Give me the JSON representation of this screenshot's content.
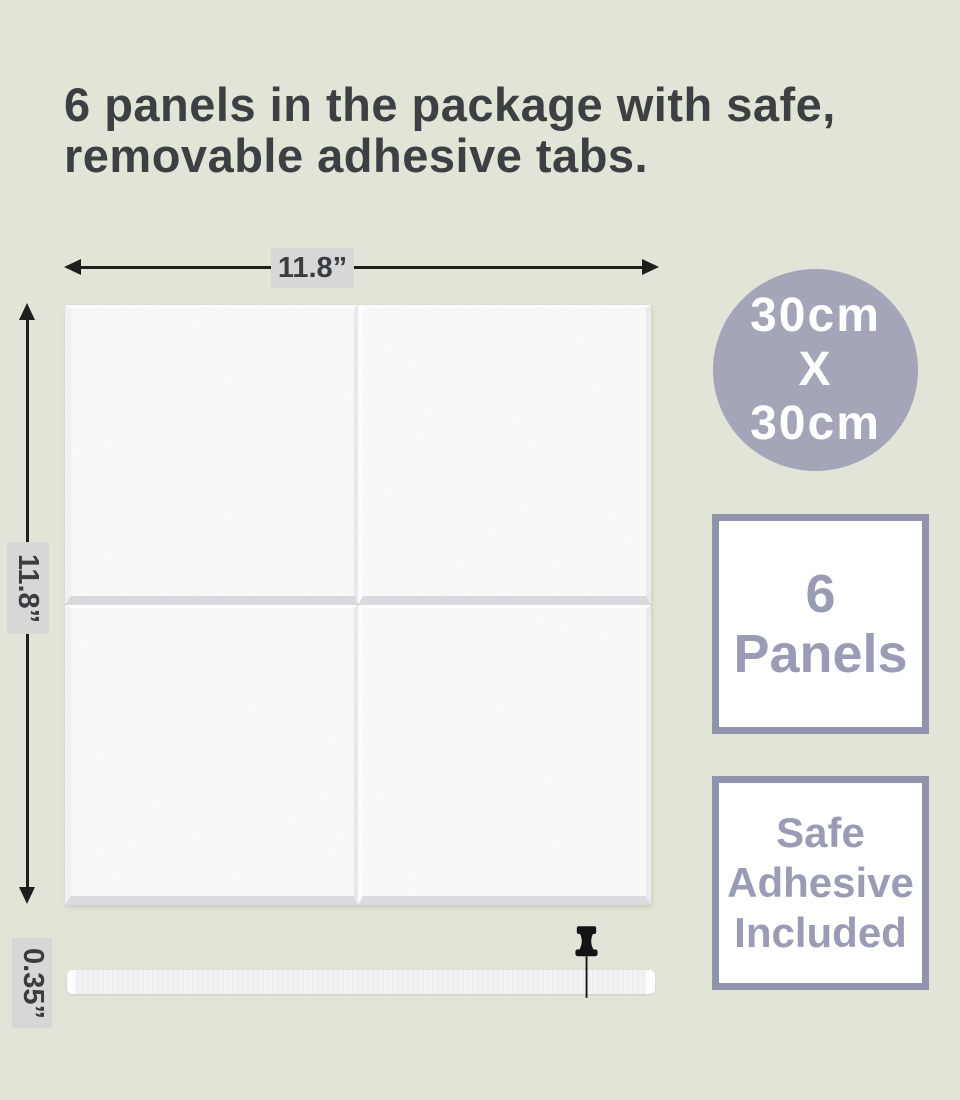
{
  "colors": {
    "page-bg": "#e1e4d6",
    "heading-text": "#3d4043",
    "arrow": "#1e1e1e",
    "dim-label-bg": "#d7d7d7",
    "dim-label-text": "#3a3d40",
    "panel-face": "#fafafb",
    "panel-bevel": "#d9d9dd",
    "circle-bg": "#a5a5ba",
    "circle-text": "#ffffff",
    "badge-border": "#9093ab",
    "badge-text": "#9a9bb4",
    "pin": "#131313",
    "strip-face": "#f3f3f5"
  },
  "heading": {
    "line1": "6 panels in the package with safe,",
    "line2": "removable adhesive tabs."
  },
  "dimensions": {
    "width": "11.8”",
    "height": "11.8”",
    "thickness": "0.35”"
  },
  "size_circle": {
    "line1": "30cm",
    "line2": "X",
    "line3": "30cm"
  },
  "panels_badge": {
    "line1": "6",
    "line2": "Panels"
  },
  "adhesive_badge": {
    "line1": "Safe",
    "line2": "Adhesive",
    "line3": "Included"
  }
}
